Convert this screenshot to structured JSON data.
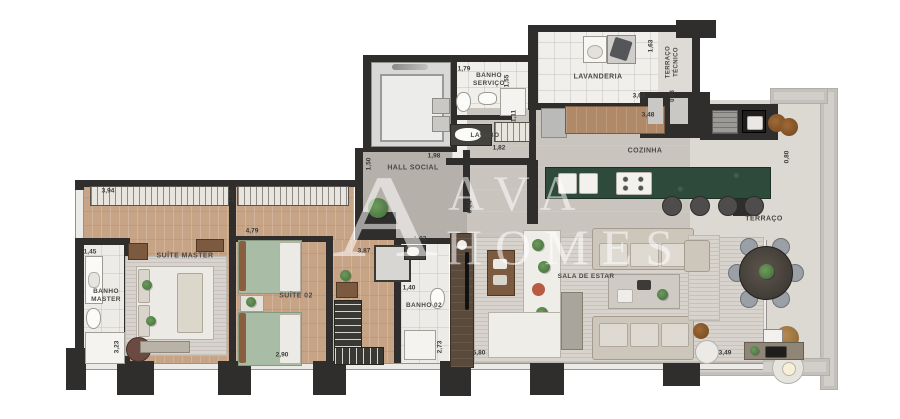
{
  "plan_title": "Apartment floor plan",
  "watermark": {
    "monogram": "A",
    "line1": "AVA",
    "line2": "HOMES"
  },
  "rooms": {
    "banho_master": "BANHO MASTER",
    "suite_master": "SUÍTE MASTER",
    "suite_02": "SUÍTE 02",
    "banho_02": "BANHO 02",
    "hall_social": "HALL SOCIAL",
    "banho_servico": "BANHO SERVIÇO",
    "lavabo": "LAVABO",
    "lavanderia": "LAVANDERIA",
    "terraco_tecnico": "TERRAÇO TÉCNICO",
    "cozinha": "COZINHA",
    "sala_de_estar": "SALA DE ESTAR",
    "terraco": "TERRAÇO"
  },
  "dims": {
    "suite_master_wardrobe": "3,94",
    "wardrobe_depth": "1,02",
    "banho_master_width": "1,45",
    "banho_master_depth": "3,23",
    "suite_master_width": "2,90",
    "suite_02_top": "4,79",
    "closet": "3,87",
    "banho_02_top": "1,03",
    "banho_02_width": "1,40",
    "banho_02_depth": "2,73",
    "sala_width": "5,80",
    "hall_left": "1,50",
    "hall_top": "1,98",
    "hall_depth": "6,04",
    "banho_servico_width": "1,79",
    "banho_servico_depth": "1,55",
    "lavabo_width": "1,82",
    "lavabo_counter": "1,11",
    "lavanderia_width": "3,62",
    "lavanderia_depth": "1,63",
    "terraco_tecnico_width": "0,63",
    "cozinha_counter": "3,48",
    "terraco_counter": "0,80",
    "terraco_width": "3,49"
  },
  "palette": {
    "wall": "#2f2e2c",
    "wood_floor": "#c8a487",
    "island_green": "#2d4a3a",
    "bed_green": "#a9bda6",
    "hall_gray": "#b6b0aa",
    "kitchen_floor": "#c9c4be",
    "terrace_floor": "#dcd8d2",
    "watermark_white": "rgba(255,255,255,0.55)"
  }
}
